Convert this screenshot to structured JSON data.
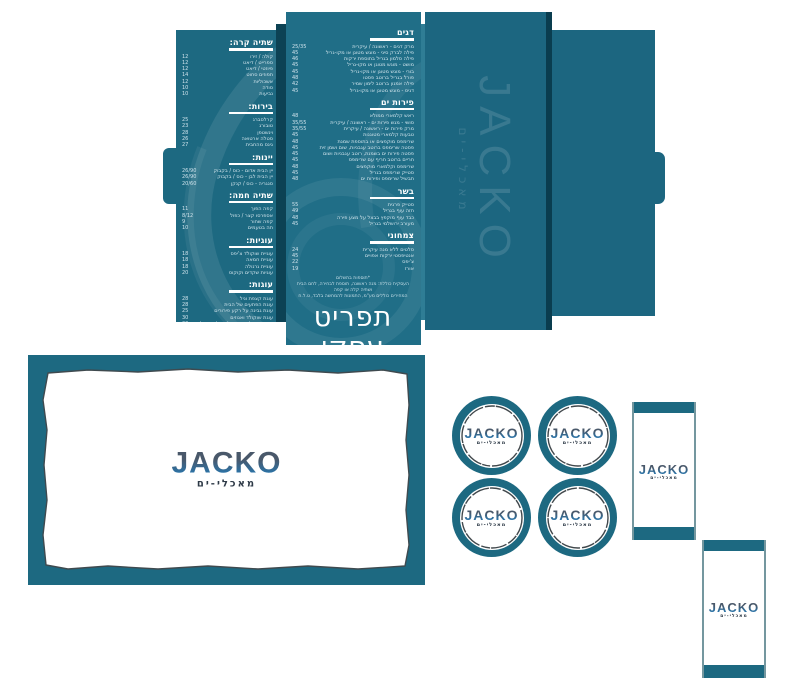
{
  "brand": {
    "name": "JACKO",
    "tagline": "מאכלי-ים"
  },
  "colors": {
    "teal": "#1d6981",
    "teal_dark": "#0c4254",
    "teal_light": "#2f7d95",
    "logo_slate": "#49586a",
    "logo_blue": "#2c73a6"
  },
  "spread": {
    "left_page": {
      "sections": [
        {
          "title": "שתיה קרה:",
          "items": [
            {
              "name": "קולה / זירו",
              "price": "12"
            },
            {
              "name": "ספרייט / דיאט",
              "price": "12"
            },
            {
              "name": "פיוזטי / דיאט",
              "price": "12"
            },
            {
              "name": "תפוזים סחוט",
              "price": "14"
            },
            {
              "name": "אשכוליות",
              "price": "12"
            },
            {
              "name": "סודה",
              "price": "10"
            },
            {
              "name": "נביעות",
              "price": "10"
            }
          ]
        },
        {
          "title": "בירות:",
          "items": [
            {
              "name": "קרלסברג",
              "price": "25"
            },
            {
              "name": "טובורג",
              "price": "23"
            },
            {
              "name": "וינשטפן",
              "price": "28"
            },
            {
              "name": "סטלה ארטואה",
              "price": "26"
            },
            {
              "name": "גינס מהחבית",
              "price": "27"
            }
          ]
        },
        {
          "title": "יינות:",
          "items": [
            {
              "name": "יין הבית אדום - כוס / בקבוק",
              "price": "26/90"
            },
            {
              "name": "יין הבית לבן - כוס / בקבוק",
              "price": "26/90"
            },
            {
              "name": "סנגריה - כוס / קנקן",
              "price": "20/60"
            }
          ]
        },
        {
          "title": "שתיה חמה:",
          "items": [
            {
              "name": "קפה הפוך",
              "price": "11"
            },
            {
              "name": "אספרסו קצר / כפול",
              "price": "8/12"
            },
            {
              "name": "קפה שחור",
              "price": "9"
            },
            {
              "name": "תה בטעמים",
              "price": "10"
            }
          ]
        },
        {
          "title": "עוגיות:",
          "items": [
            {
              "name": "עוגיית שוקולד צ'יפס",
              "price": "18"
            },
            {
              "name": "עוגיית חמאה",
              "price": "18"
            },
            {
              "name": "עוגיית גרנולה",
              "price": "18"
            },
            {
              "name": "עוגיות שקדים וקוקוס",
              "price": "20"
            }
          ]
        },
        {
          "title": "עוגות:",
          "items": [
            {
              "name": "עוגת קצפת וניל",
              "price": "28"
            },
            {
              "name": "עוגת הפתעים של הבית",
              "price": "28"
            },
            {
              "name": "עוגת גבינה על רקע פירורים",
              "price": "25"
            },
            {
              "name": "עוגת שוקולד ואגוזים",
              "price": "30"
            },
            {
              "name": "עוגת שוקולד חמה בליווי גלידה וניל",
              "price": "30"
            },
            {
              "name": "עוגת אוכמניות וקרם פקאן",
              "price": "28"
            }
          ]
        }
      ],
      "footnote": [
        "*ניתן לקבל שינויים בהרכב המנות",
        "אין כפל מבצעים, ט.ל.ח"
      ]
    },
    "right_page": {
      "sections": [
        {
          "title": "דגים",
          "items": [
            {
              "name": "מרק דגים - ראשונה / עיקרית",
              "price": "25/35"
            },
            {
              "name": "פילה לברק סיני - מוגש מטוגן או מקו-גריל",
              "price": "45"
            },
            {
              "name": "פילה סלמון בגריל בתוספת ירקות",
              "price": "46"
            },
            {
              "name": "מושט - מוגש מטוגן או מקו-גריל",
              "price": "45"
            },
            {
              "name": "בורי - מוגש מטוגן או מקו-גריל",
              "price": "45"
            },
            {
              "name": "פורל בגריל ברוטב פסטו",
              "price": "48"
            },
            {
              "name": "פילה אמנון ברוטב לימון שמיר",
              "price": "42"
            },
            {
              "name": "דניס - מוגש מטוגן או מקו-גריל",
              "price": "45"
            }
          ]
        },
        {
          "title": "פירות ים",
          "items": [
            {
              "name": "ראש קלמארי ממולא",
              "price": "48"
            },
            {
              "name": "סושי - מגש פירות ים - ראשונה / עיקרית",
              "price": "35/55"
            },
            {
              "name": "מרק פירות ים - ראשונה / עיקרית",
              "price": "35/55"
            },
            {
              "name": "טבעות קלמארי מטוגנות",
              "price": "45"
            },
            {
              "name": "שרימפס מוקפצים או בתוספת שמנת",
              "price": "48"
            },
            {
              "name": "פסטה שרימפס ברוטב עגבניות, שום ושמן זית",
              "price": "45"
            },
            {
              "name": "פסטה פירות ים בשמנת, רוטב עגבניות ושום",
              "price": "45"
            },
            {
              "name": "חריים ברוטב חריף עם שרימפס",
              "price": "45"
            },
            {
              "name": "שרימפס וקלמארי מוקפצים",
              "price": "48"
            },
            {
              "name": "סטייק שרימפס בגריל",
              "price": "45"
            },
            {
              "name": "תבשיל שרימפס ופירות ים",
              "price": "48"
            }
          ]
        },
        {
          "title": "בשר",
          "items": [
            {
              "name": "סטייק פרגית",
              "price": "55"
            },
            {
              "name": "חזה עוף בגריל",
              "price": "49"
            },
            {
              "name": "כבד עוף מוקפץ בבצל על מצע פירה",
              "price": "48"
            },
            {
              "name": "מעורב ירושלמי בגריל",
              "price": "45"
            }
          ]
        },
        {
          "title": "צמחוני",
          "items": [
            {
              "name": "סלטים ללא מנה עיקרית",
              "price": "24"
            },
            {
              "name": "אנטיפסטי ירקות אפויים",
              "price": "45"
            },
            {
              "name": "צ'יפס",
              "price": "22"
            },
            {
              "name": "אורז",
              "price": "19"
            }
          ]
        }
      ],
      "notes": [
        "*תוספות בתשלום",
        "העסקית כוללת: מנה ראשונה, תוספת לבחירה, לחם הבית ושתיה קלה או קפה",
        "המחירים כוללים מע\"מ, התמונות להמחשה בלבד, ט.ל.ח"
      ],
      "big_title": "תפריט עסקי"
    }
  },
  "cover": {
    "logo": "JACKO",
    "tagline": "מאכלי-ים"
  },
  "placemat": {
    "logo": "JACKO",
    "tagline": "מאכלי-ים"
  },
  "coasters": {
    "count": 4,
    "logo": "JACKO",
    "tagline": "מאכלי-ים"
  },
  "sleeves": {
    "count": 2,
    "logo": "JACKO",
    "tagline": "מאכלי-ים"
  }
}
